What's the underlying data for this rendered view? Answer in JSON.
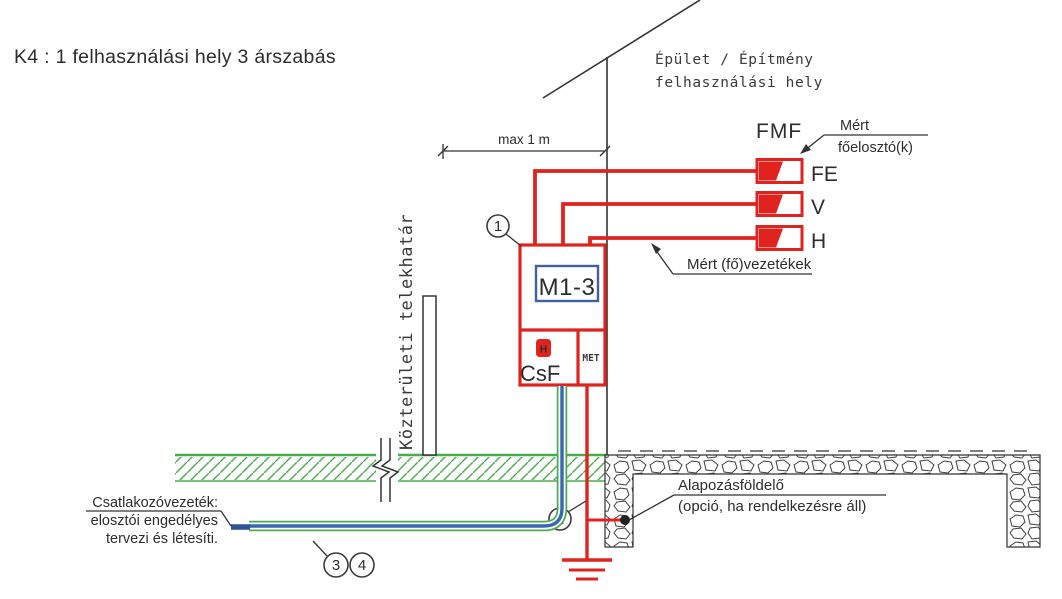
{
  "title": "K4 : 1 felhasználási hely 3 árszabás",
  "building": {
    "line1": "Épület / Építmény",
    "line2": "felhasználási hely"
  },
  "dimension": {
    "label": "max 1 m"
  },
  "main_distributor": {
    "code": "FMF",
    "note_line1": "Mért",
    "note_line2": "főelosztó(k)"
  },
  "tariffs": {
    "fe": "FE",
    "v": "V",
    "h": "H"
  },
  "measured_mains_note": "Mért (fő)vezetékek",
  "meter_box": {
    "meter_id": "M1-3",
    "csf_label": "CsF",
    "met_label": "MET",
    "fuse_label": "H"
  },
  "boundary_label": "Közterületi telekhatár",
  "foundation_note": {
    "line1": "Alapozásföldelő",
    "line2": "(opció, ha rendelkezésre áll)"
  },
  "cable_note": {
    "line1": "Csatlakozóvezeték:",
    "line2": "elosztói engedélyes",
    "line3": "tervezi és létesíti."
  },
  "callouts": {
    "c1": "1",
    "c2": "2",
    "c3": "3",
    "c4": "4"
  },
  "colors": {
    "red": "#e0231f",
    "green": "#4aad4d",
    "cable_blue": "#3a67b0",
    "meter_blue": "#41619e",
    "line": "#333333",
    "text": "#2d2d2d"
  }
}
